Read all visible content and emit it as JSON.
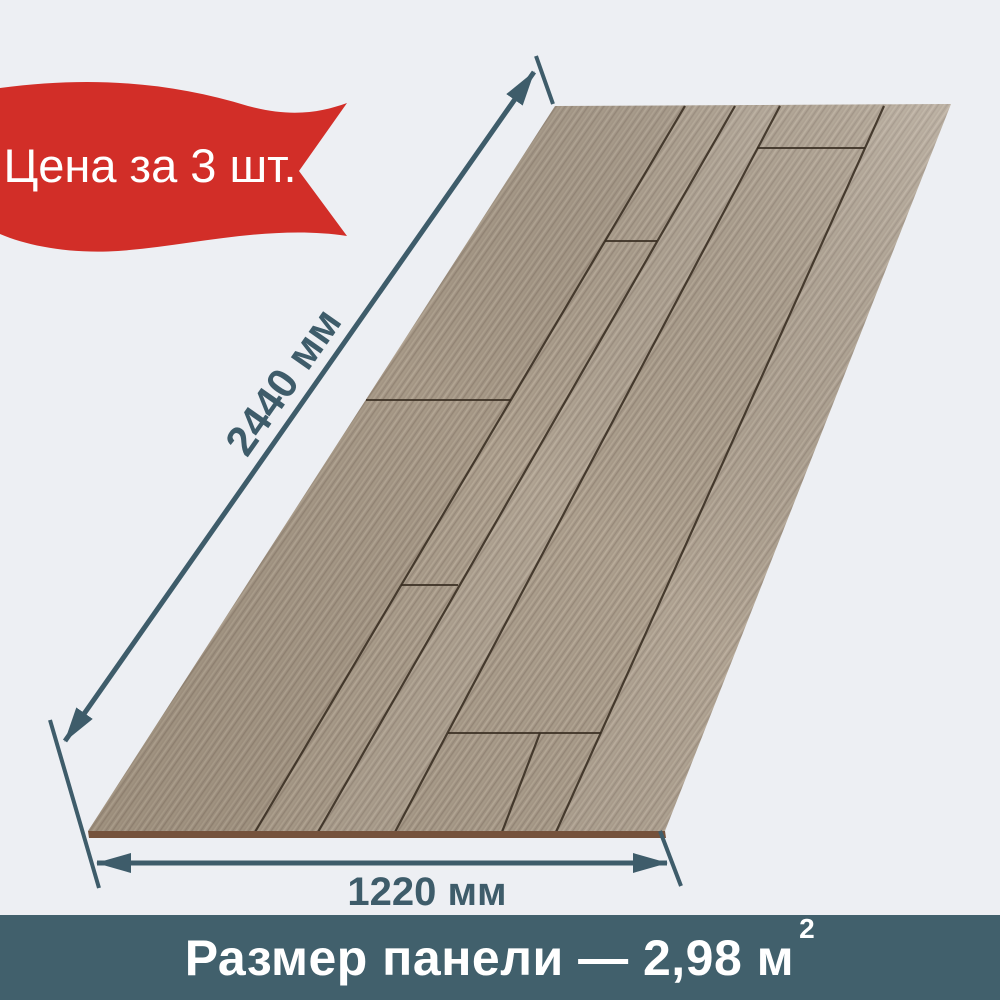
{
  "background": "#edeff3",
  "badge": {
    "label": "Цена за 3 шт.",
    "ribbon_color": "#d22e28",
    "text_color": "#ffffff"
  },
  "dimensions": {
    "arrow_color": "#3e5c6a",
    "length_label": "2440 мм",
    "width_label": "1220 мм"
  },
  "panel": {
    "base_color": "#a89a89",
    "seam_color": "#382d21",
    "edge_color": "#75523c"
  },
  "footer": {
    "text": "Размер панели — 2,98 м",
    "sup": "2",
    "bg_color": "#41606c",
    "text_color": "#ffffff"
  }
}
